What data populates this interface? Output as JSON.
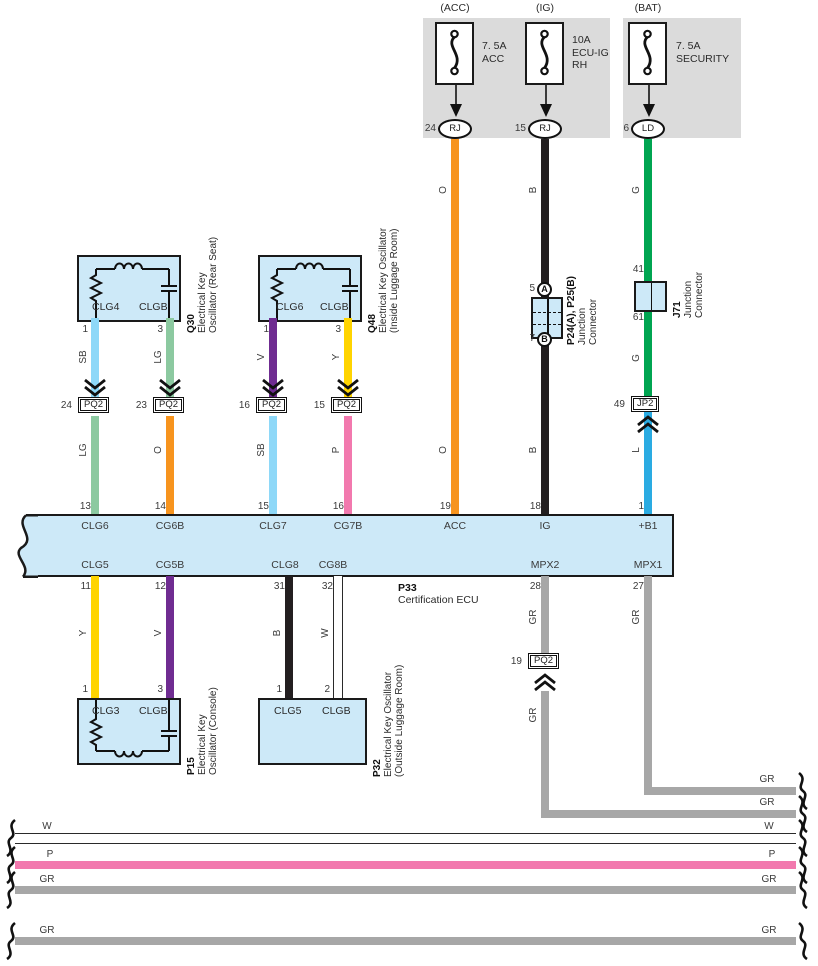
{
  "colors": {
    "orange": "#F7941E",
    "black_wire": "#231F20",
    "green": "#00A551",
    "light_green": "#8CC9A0",
    "sky_blue": "#8ED8F8",
    "violet": "#6F2C91",
    "yellow": "#FFD400",
    "pink": "#F279AE",
    "blue": "#2AABE2",
    "gray": "#A7A7A7",
    "white_wire": "#FFFFFF",
    "component_fill": "#CDE9F8",
    "panel_bg": "#DBDBDB"
  },
  "fuse_panel": {
    "fuses": [
      {
        "system": "(ACC)",
        "rating": "7. 5A",
        "name": "ACC",
        "name2": "",
        "pin": "24",
        "connector": "RJ"
      },
      {
        "system": "(IG)",
        "rating": "10A",
        "name": "ECU-IG",
        "name2": "RH",
        "pin": "15",
        "connector": "RJ"
      },
      {
        "system": "(BAT)",
        "rating": "7. 5A",
        "name": "SECURITY",
        "name2": "",
        "pin": "6",
        "connector": "LD"
      }
    ]
  },
  "components": {
    "q30": {
      "id": "Q30",
      "desc_line1": "Electrical Key",
      "desc_line2": "Oscillator (Rear Seat)",
      "terminal_left": "CLG4",
      "terminal_right": "CLGB",
      "pin_left": "1",
      "pin_right": "3"
    },
    "q48": {
      "id": "Q48",
      "desc_line1": "Electrical Key Oscillator",
      "desc_line2": "(Inside Luggage Room)",
      "terminal_left": "CLG6",
      "terminal_right": "CLGB",
      "pin_left": "1",
      "pin_right": "3"
    },
    "p15": {
      "id": "P15",
      "desc_line1": "Electrical Key",
      "desc_line2": "Oscillator (Console)",
      "terminal_left": "CLG3",
      "terminal_right": "CLGB",
      "pin_left": "1",
      "pin_right": "3"
    },
    "p32": {
      "id": "P32",
      "desc_line1": "Electrical Key Oscillator",
      "desc_line2": "(Outside Luggage Room)",
      "terminal_left": "CLG5",
      "terminal_right": "CLGB",
      "pin_left": "1",
      "pin_right": "2"
    },
    "p24_p25": {
      "id": "P24(A), P25(B)",
      "desc_line1": "Junction",
      "desc_line2": "Connector",
      "pin_top": "5",
      "pin_bottom": "7",
      "tap_top": "A",
      "tap_bottom": "B"
    },
    "j71": {
      "id": "J71",
      "desc_line1": "Junction",
      "desc_line2": "Connector",
      "pin_top": "41",
      "pin_bottom": "61"
    },
    "p33": {
      "id": "P33",
      "desc": "Certification ECU",
      "top_pins": [
        {
          "num": "13",
          "terminal": "CLG6"
        },
        {
          "num": "14",
          "terminal": "CG6B"
        },
        {
          "num": "15",
          "terminal": "CLG7"
        },
        {
          "num": "16",
          "terminal": "CG7B"
        },
        {
          "num": "19",
          "terminal": "ACC"
        },
        {
          "num": "18",
          "terminal": "IG"
        },
        {
          "num": "1",
          "terminal": "+B1"
        }
      ],
      "bottom_pins": [
        {
          "num": "11",
          "terminal": "CLG5"
        },
        {
          "num": "12",
          "terminal": "CG5B"
        },
        {
          "num": "31",
          "terminal": "CLG8"
        },
        {
          "num": "32",
          "terminal": "CG8B"
        },
        {
          "num": "28",
          "terminal": "MPX2"
        },
        {
          "num": "27",
          "terminal": "MPX1"
        }
      ]
    }
  },
  "inline_connectors": {
    "pq2_24": {
      "pin": "24",
      "name": "PQ2"
    },
    "pq2_23": {
      "pin": "23",
      "name": "PQ2"
    },
    "pq2_16": {
      "pin": "16",
      "name": "PQ2"
    },
    "pq2_15": {
      "pin": "15",
      "name": "PQ2"
    },
    "jp2_49": {
      "pin": "49",
      "name": "JP2"
    },
    "pq2_19": {
      "pin": "19",
      "name": "PQ2"
    }
  },
  "wire_codes": {
    "acc": "O",
    "ig": "B",
    "bat": "G",
    "b1": "L",
    "q30_pin1": "SB",
    "q30_pin3": "LG",
    "q48_pin1": "V",
    "q48_pin3": "Y",
    "clg6": "LG",
    "cg6b": "O",
    "clg7": "SB",
    "cg7b": "P",
    "clg5": "Y",
    "cg5b": "V",
    "clg8": "B",
    "cg8b": "W",
    "mpx2": "GR",
    "mpx1": "GR",
    "bus_w": "W",
    "bus_p": "P",
    "bus_gr1": "GR",
    "bus_gr2": "GR"
  }
}
